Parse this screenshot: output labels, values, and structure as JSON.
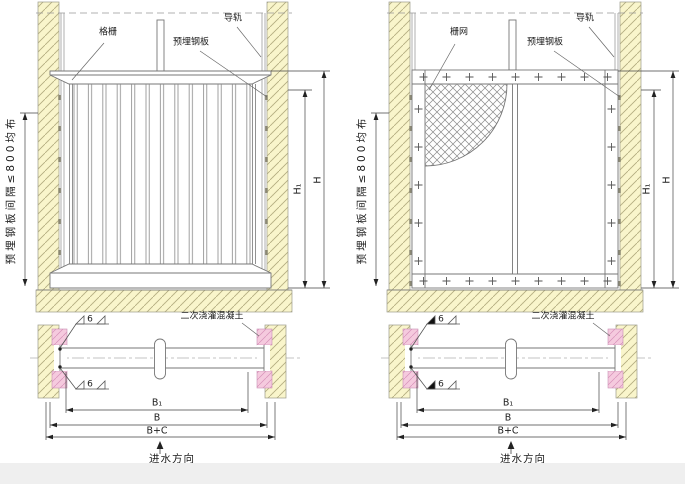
{
  "drawing": {
    "type": "engineering-installation-diagram",
    "views": [
      "elevation",
      "plan"
    ]
  },
  "labels": {
    "guide_rail": "导轨",
    "embedded_plate": "预埋钢板",
    "spacing_note": "预埋钢板间隔≤800均布",
    "secondary_concrete": "二次浇灌混凝土",
    "flow_direction": "进水方向",
    "weld_size": "6",
    "dim_h1": "H₁",
    "dim_h": "H",
    "dim_b1": "B₁",
    "dim_b": "B",
    "dim_b_plus_c": "B+C"
  },
  "left_drawing": {
    "component_label": "格栅"
  },
  "right_drawing": {
    "component_label": "栅网"
  },
  "colors": {
    "wall_fill": "#f9f5cb",
    "wall_hatch_line": "#b1aa7d",
    "concrete_fill": "#f5cade",
    "concrete_hatch_line": "#d791b8",
    "structure_line": "#777777",
    "dimension_line": "#444444"
  }
}
